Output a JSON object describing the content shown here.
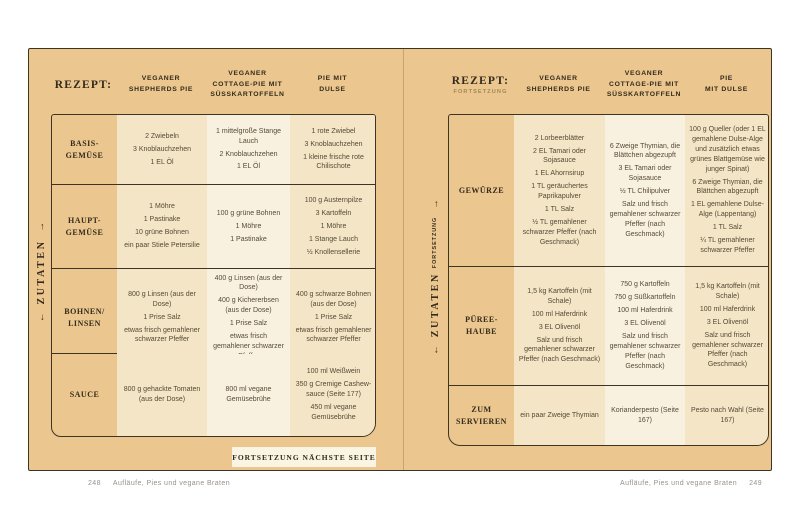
{
  "colors": {
    "page_bg": "#ebc68e",
    "cell_cream": "#f3e5c5",
    "cell_light": "#f9f1e0",
    "box_bg": "#faf4e3",
    "ink": "#332b1c",
    "text": "#554a36",
    "muted": "#97928a",
    "border": "#3e3425"
  },
  "left_page": {
    "header": {
      "title": "REZEPT:"
    },
    "columns": [
      "VEGANER\nSHEPHERDS PIE",
      "VEGANER\nCOTTAGE-PIE MIT\nSÜSSKARTOFFELN",
      "PIE MIT\nDULSE"
    ],
    "sidebar": {
      "label": "ZUTATEN",
      "arrow_down": "←",
      "arrow_up": "→"
    },
    "rows": [
      {
        "label": "BASIS-\nGEMÜSE",
        "cells": [
          [
            "2 Zwiebeln",
            "3 Knoblauchzehen",
            "1 EL Öl"
          ],
          [
            "1 mittelgroße Stange Lauch",
            "2 Knoblauchzehen",
            "1 EL Öl"
          ],
          [
            "1 rote Zwiebel",
            "3 Knoblauchzehen",
            "1 kleine frische rote Chilischote"
          ]
        ]
      },
      {
        "label": "HAUPT-\nGEMÜSE",
        "cells": [
          [
            "1 Möhre",
            "1 Pastinake",
            "10 grüne Bohnen",
            "ein paar Stiele Petersilie"
          ],
          [
            "100 g grüne Bohnen",
            "1 Möhre",
            "1 Pastinake"
          ],
          [
            "100 g Austernpilze",
            "3 Kartoffeln",
            "1 Möhre",
            "1 Stange Lauch",
            "½ Knollensellerie"
          ]
        ]
      },
      {
        "label": "BOHNEN/\nLINSEN",
        "cells": [
          [
            "800 g Linsen (aus der Dose)",
            "1 Prise Salz",
            "etwas frisch gemahlener schwarzer Pfeffer"
          ],
          [
            "400 g Linsen (aus der Dose)",
            "400 g Kichererbsen (aus der Dose)",
            "1 Prise Salz",
            "etwas frisch gemahlener schwarzer Pfeffer"
          ],
          [
            "400 g schwarze Bohnen (aus der Dose)",
            "1 Prise Salz",
            "etwas frisch gemahlener schwarzer Pfeffer"
          ]
        ]
      },
      {
        "label": "SAUCE",
        "cells": [
          [
            "800 g gehackte Tomaten (aus der Dose)"
          ],
          [
            "800 ml vegane Gemüsebrühe"
          ],
          [
            "100 ml Weißwein",
            "350 g Cremige Cashew-sauce (Seite 177)",
            "450 ml vegane Gemüsebrühe"
          ]
        ]
      }
    ],
    "continuation_note": "FORTSETZUNG NÄCHSTE SEITE",
    "footer": {
      "page_number": "248",
      "text": "Aufläufe, Pies und vegane Braten"
    }
  },
  "right_page": {
    "header": {
      "title": "REZEPT:",
      "subtitle": "FORTSETZUNG"
    },
    "columns": [
      "VEGANER\nSHEPHERDS PIE",
      "VEGANER\nCOTTAGE-PIE MIT\nSÜSSKARTOFFELN",
      "PIE\nMIT DULSE"
    ],
    "sidebar": {
      "label": "ZUTATEN",
      "sublabel": "FORTSETZUNG",
      "arrow_down": "←",
      "arrow_up": "→"
    },
    "rows": [
      {
        "label": "GEWÜRZE",
        "cells": [
          [
            "2 Lorbeerblätter",
            "2 EL Tamari oder Sojasauce",
            "1 EL Ahornsirup",
            "1 TL geräuchertes Paprikapulver",
            "1 TL Salz",
            "½ TL gemahlener schwarzer Pfeffer (nach Geschmack)"
          ],
          [
            "6 Zweige Thymian, die Blättchen abgezupft",
            "3 EL Tamari oder Sojasauce",
            "½ TL Chilipulver",
            "Salz und frisch gemahlener schwarzer Pfeffer (nach Geschmack)"
          ],
          [
            "100 g Queller (oder 1 EL gemahlene Dulse-Alge und zusätzlich etwas grünes Blattgemüse wie junger Spinat)",
            "6 Zweige Thymian, die Blättchen abgezupft",
            "1 EL gemahlene Dulse-Alge (Lappentang)",
            "1 TL Salz",
            "¼ TL gemahlener schwarzer Pfeffer"
          ]
        ]
      },
      {
        "label": "PÜREE-\nHAUBE",
        "cells": [
          [
            "1,5 kg Kartoffeln (mit Schale)",
            "100 ml Haferdrink",
            "3 EL Olivenöl",
            "Salz und frisch gemahlener schwarzer Pfeffer (nach Geschmack)"
          ],
          [
            "750 g Kartoffeln",
            "750 g Süßkartoffeln",
            "100 ml Haferdrink",
            "3 EL Olivenöl",
            "Salz und frisch gemahlener schwarzer Pfeffer (nach Geschmack)"
          ],
          [
            "1,5 kg Kartoffeln (mit Schale)",
            "100 ml Haferdrink",
            "3 EL Olivenöl",
            "Salz und frisch gemahlener schwarzer Pfeffer (nach Geschmack)"
          ]
        ]
      },
      {
        "label": "ZUM\nSERVIEREN",
        "cells": [
          [
            "ein paar Zweige Thymian"
          ],
          [
            "Korianderpesto (Seite 167)"
          ],
          [
            "Pesto nach Wahl (Seite 167)"
          ]
        ]
      }
    ],
    "footer": {
      "text": "Aufläufe, Pies und vegane Braten",
      "page_number": "249"
    }
  }
}
